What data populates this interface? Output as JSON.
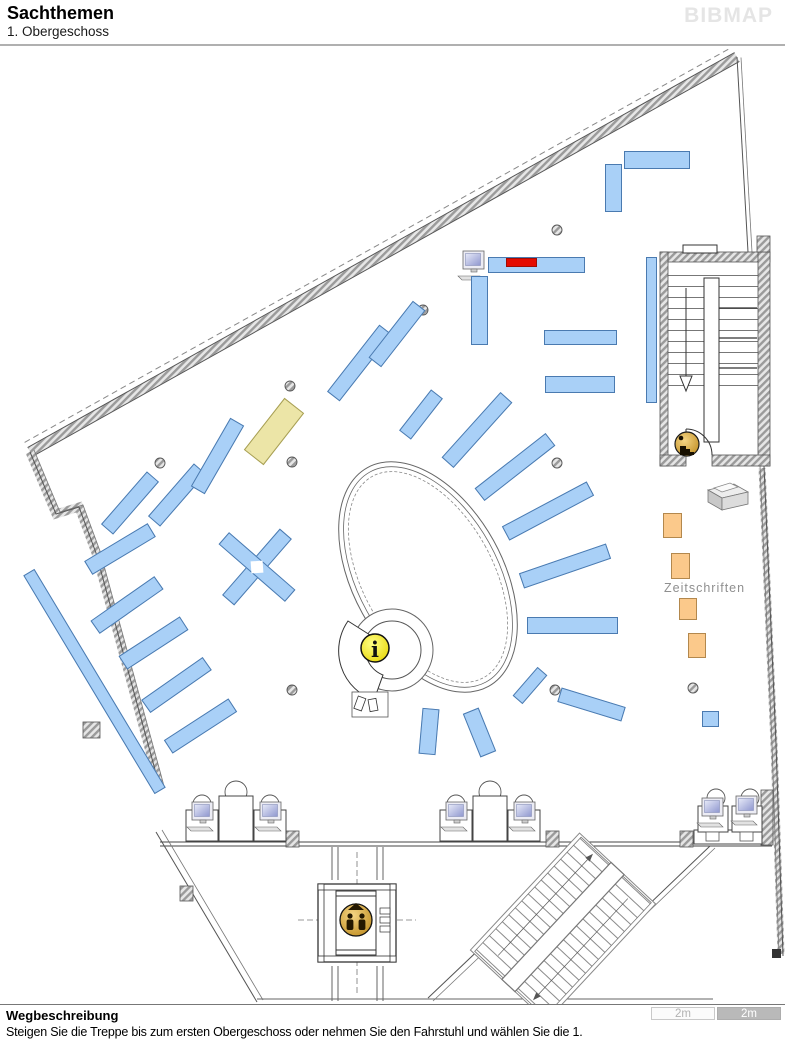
{
  "header": {
    "title": "Sachthemen",
    "subtitle": "1. Obergeschoss",
    "logo": "BIBMAP"
  },
  "map": {
    "zeitschriften_label": "Zeitschriften",
    "info_glyph": "i",
    "colors": {
      "shelf_blue": "#a9d0f7",
      "shelf_highlight_red": "#e50b00",
      "shelf_special_yellow": "#ece5a7",
      "shelf_magazine_orange": "#fbc98b",
      "icon_gold": "#d9a62e",
      "info_icon_yellow": "#f0e000"
    }
  },
  "footer": {
    "heading": "Wegbeschreibung",
    "description": "Steigen Sie die Treppe bis zum ersten Obergeschoss oder nehmen Sie den Fahrstuhl und wählen Sie die 1.",
    "scale": {
      "left_label": "2m",
      "right_label": "2m"
    }
  }
}
